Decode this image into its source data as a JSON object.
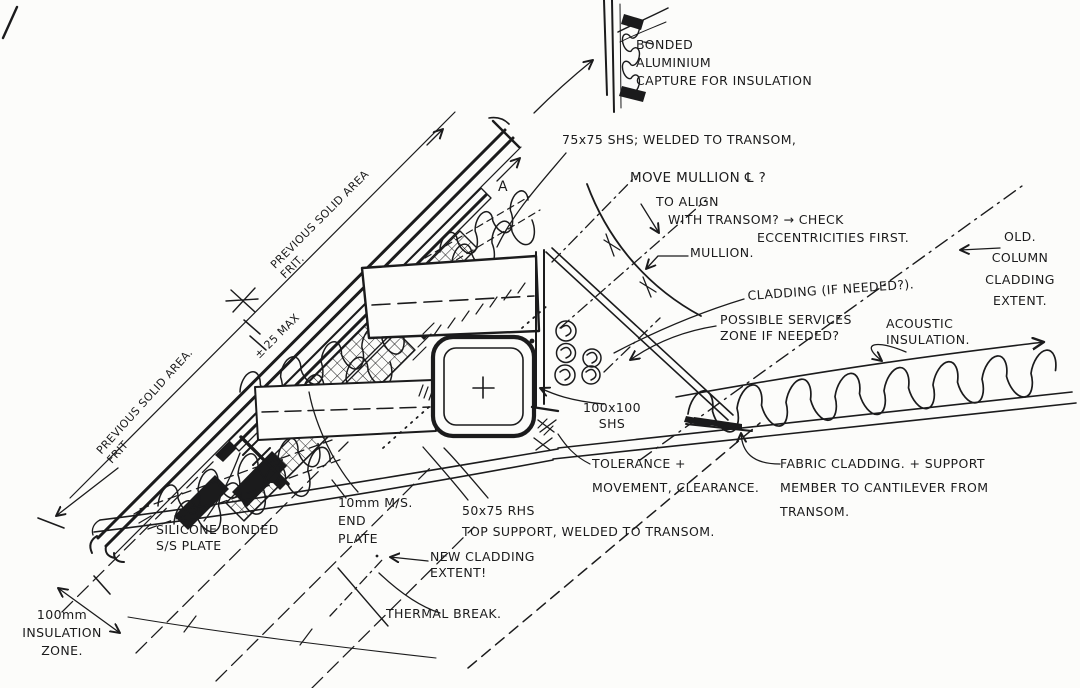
{
  "colors": {
    "ink": "#1b1b1c",
    "paper": "#fcfcfa"
  },
  "labels": {
    "bonded_capture": "BONDED\nALUMINIUM\nCAPTURE FOR INSULATION",
    "shs_75": "75x75 SHS; WELDED TO TRANSOM,",
    "move_mullion": "MOVE MULLION ℄ ?",
    "to_align": "TO ALIGN",
    "with_transom": "WITH TRANSOM? → CHECK",
    "eccentricities": "ECCENTRICITIES FIRST.",
    "mullion": "MULLION.",
    "cladding_if_needed": "CLADDING (IF NEEDED?).",
    "old_column": "OLD.\nCOLUMN\nCLADDING\nEXTENT.",
    "possible_services": "POSSIBLE SERVICES\nZONE IF NEEDED?",
    "acoustic": "ACOUSTIC\nINSULATION.",
    "shs_100": "100x100\nSHS",
    "tolerance": "TOLERANCE +\nMOVEMENT, CLEARANCE.",
    "fabric": "FABRIC CLADDING. + SUPPORT\nMEMBER TO CANTILEVER FROM\nTRANSOM.",
    "silicone": "SILICONE BONDED\nS/S PLATE",
    "end_plate": "10mm M/S.\nEND\nPLATE",
    "rhs_50": "50x75 RHS\nTOP SUPPORT, WELDED TO TRANSOM.",
    "new_cladding": "NEW CLADDING\nEXTENT!",
    "thermal": "THERMAL BREAK.",
    "insulation_zone": "100mm\nINSULATION\nZONE.",
    "prev_solid_1": "PREVIOUS SOLID AREA\nFRIT.",
    "prev_solid_2": "PREVIOUS SOLID AREA.\nFRIT",
    "plus_minus": "± 25 MAX",
    "section_a": "A"
  }
}
